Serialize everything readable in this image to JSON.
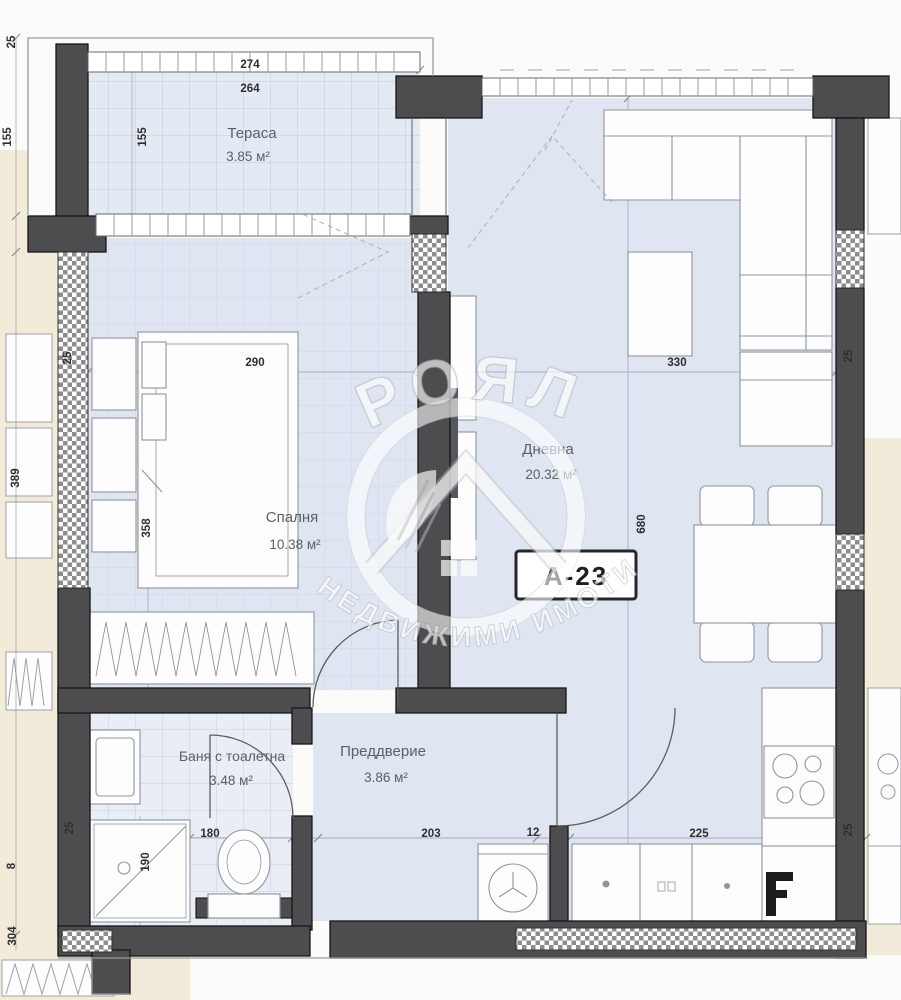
{
  "unit": {
    "label": "А-23"
  },
  "watermark": {
    "brand": "РОЯЛ",
    "tagline": "НЕДВИЖИМИ ИМОТИ"
  },
  "rooms": [
    {
      "id": "terrace",
      "name": "Тераса",
      "area": "3.85 м²"
    },
    {
      "id": "bedroom",
      "name": "Спалня",
      "area": "10.38 м²"
    },
    {
      "id": "living",
      "name": "Дневна",
      "area": "20.32 м²"
    },
    {
      "id": "bathroom",
      "name": "Баня с тоалетна",
      "area": "3.48 м²"
    },
    {
      "id": "hallway",
      "name": "Преддверие",
      "area": "3.86 м²"
    }
  ],
  "dimensions": {
    "d274": "274",
    "d264": "264",
    "d155": "155",
    "d25": "25",
    "d290": "290",
    "d358": "358",
    "d389": "389",
    "d330": "330",
    "d680": "680",
    "d180": "180",
    "d190": "190",
    "d203": "203",
    "d12": "12",
    "d225": "225",
    "d8": "8",
    "d304": "304"
  },
  "colors": {
    "wall": "#4d4d4f",
    "room_fill": "#dfe6f1",
    "bath_fill": "#e9eef6",
    "terrace_fill": "#e4eaf4",
    "neighbor_cream": "#f2ebd9",
    "hatch_gray": "#8d8d8d",
    "dim_text": "#2e2e30",
    "label_text": "#5a5f68",
    "watermark_white": "#ffffff"
  }
}
